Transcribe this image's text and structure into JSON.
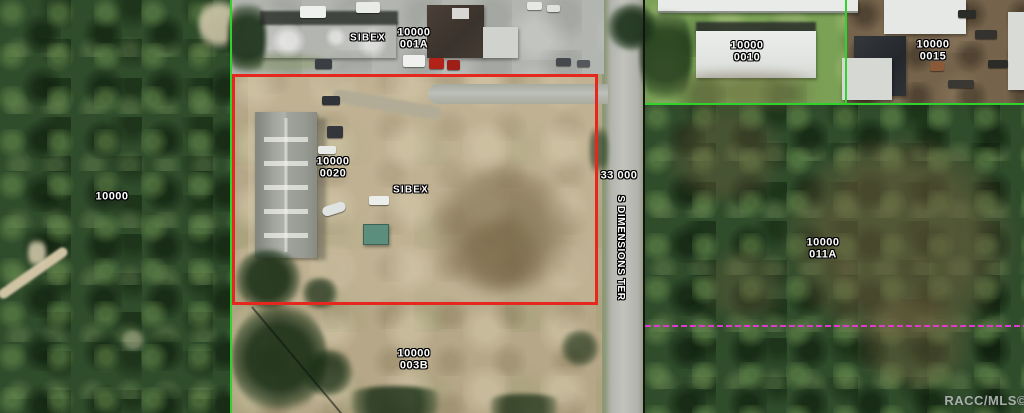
{
  "map": {
    "labels": {
      "sibex_top": "SIBEX",
      "sibex_center": "SIBEX",
      "parcel_001a": {
        "l1": "10000",
        "l2": "001A"
      },
      "parcel_0010": {
        "l1": "10000",
        "l2": "0010"
      },
      "parcel_0015": {
        "l1": "10000",
        "l2": "0015"
      },
      "parcel_0020": {
        "l1": "10000",
        "l2": "0020"
      },
      "parcel_011a": {
        "l1": "10000",
        "l2": "011A"
      },
      "parcel_003b": {
        "l1": "10000",
        "l2": "003B"
      },
      "parcel_left": "10000",
      "parcel_33000": "33 000",
      "road_name": "S DIMENSIONS TER",
      "watermark": "RACC/MLS©"
    },
    "colors": {
      "selection_outline": "#e5271e",
      "parcel_boundary_green": "#2fd32b",
      "parcel_boundary_black": "#141414",
      "easement_magenta": "#de3bcd",
      "label_text": "#ffffff"
    }
  }
}
